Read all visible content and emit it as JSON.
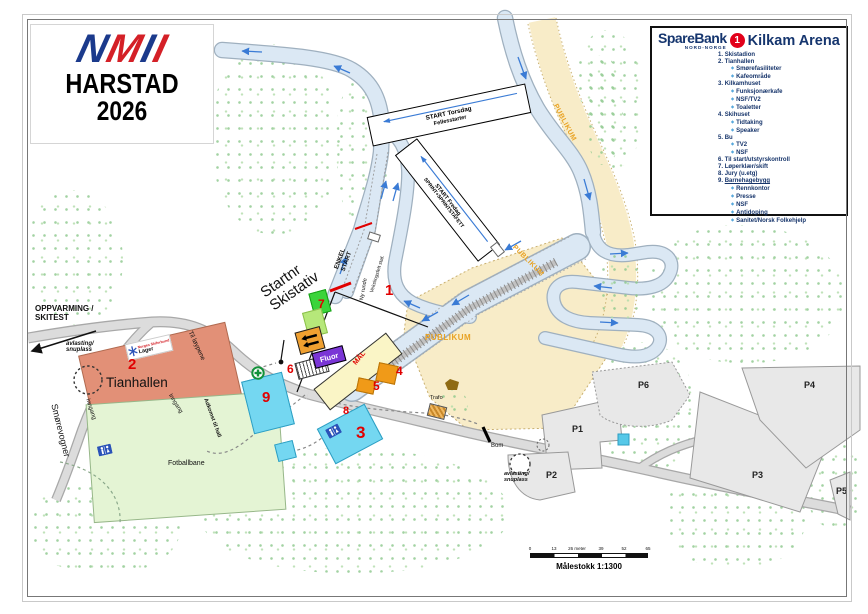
{
  "header": {
    "logo_letters": [
      "N",
      "M",
      "I",
      "I"
    ],
    "city": "HARSTAD",
    "year": "2026"
  },
  "legend": {
    "bank": "SpareBank",
    "bank_region": "NORD-NORGE",
    "badge": "1",
    "title": "Kilkam Arena",
    "bullet": "◆",
    "items": [
      {
        "num": "1.",
        "label": "Skistadion",
        "subs": []
      },
      {
        "num": "2.",
        "label": "Tianhallen",
        "subs": [
          "Smørefasiliteter",
          "Kafeområde"
        ]
      },
      {
        "num": "3.",
        "label": "Kilkamhuset",
        "subs": [
          "Funksjonærkafe",
          "NSF/TV2",
          "Toaletter"
        ]
      },
      {
        "num": "4.",
        "label": "Skihuset",
        "subs": [
          "Tidtaking",
          "Speaker"
        ]
      },
      {
        "num": "5.",
        "label": "Bu",
        "subs": [
          "TV2",
          "NSF"
        ]
      },
      {
        "num": "6.",
        "label": "Til start/utstyrskontroll",
        "subs": []
      },
      {
        "num": "7.",
        "label": "Løperklær/skift",
        "subs": []
      },
      {
        "num": "8.",
        "label": "Jury (u.etg)",
        "subs": []
      },
      {
        "num": "9.",
        "label": "Barnehagebygg",
        "subs": [
          "Rennkontor",
          "Presse",
          "NSF",
          "Antidoping",
          "Sanitet/Norsk Folkehjelp"
        ]
      }
    ]
  },
  "map": {
    "markers": [
      "1",
      "2",
      "3",
      "4",
      "5",
      "6",
      "7",
      "8",
      "9"
    ],
    "parking": [
      "P1",
      "P2",
      "P3",
      "P4",
      "P5",
      "P6"
    ],
    "labels": {
      "oppvarming1": "OPPVARMING /",
      "oppvarming2": "SKITEST",
      "avlasting1": "avlasting/",
      "avlasting2": "snuplass",
      "smorevogner": "Smørevogner",
      "til_loypene": "Til løypene",
      "inngang": "Inngang",
      "tianhallen": "Tianhallen",
      "fotballbane": "Fotballbane",
      "adkomst": "Adkomst til hall",
      "startnr1": "Startnr",
      "startnr2": "Skistativ",
      "enkel1": "ENKEL",
      "enkel2": "START",
      "veksling": "Vekslingsfelt staf.",
      "ny_runde": "Ny runde",
      "start_tor1": "START Torsdag",
      "start_tor2": "Fellesstarter",
      "start_fre1": "START Fredag",
      "start_fre2": "SPRINT+SPRINTSTAFETT",
      "publikum": "PUBLIKUM",
      "mal": "MÅL",
      "fluor": "Fluor",
      "trafo": "Trafo",
      "bom": "Bom"
    },
    "chip": {
      "brand": "Norges Skiforbund",
      "label": "Lager"
    },
    "scale": {
      "ticks": [
        "0",
        "13",
        "26 meter",
        "39",
        "52",
        "65"
      ],
      "caption": "Målestokk 1:1300"
    },
    "colors": {
      "trail": "#dbe8f4",
      "publikum_area": "#f8ecc8",
      "publikum_text": "#e8a223",
      "marker_red": "#e00000",
      "tianhallen": "#e29077",
      "kilkamhuset": "#74d7f1",
      "fotballbane": "#e4f4d4",
      "skihuset_orange": "#f09a18",
      "fluor_purple": "#7a35d6",
      "navy": "#15356e",
      "bank_red": "#e2001a"
    }
  }
}
